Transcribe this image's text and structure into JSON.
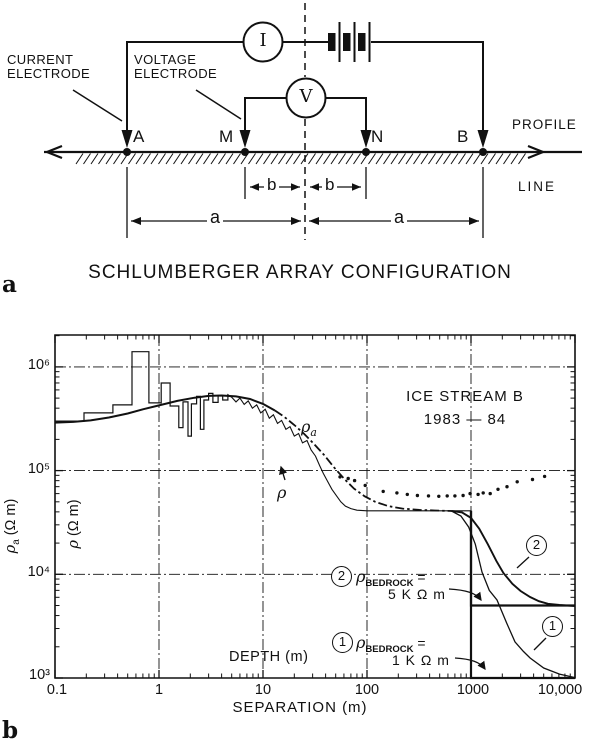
{
  "panel_a": {
    "label": "a",
    "title": "SCHLUMBERGER ARRAY CONFIGURATION",
    "current_electrode": "CURRENT\nELECTRODE",
    "voltage_electrode": "VOLTAGE\nELECTRODE",
    "ammeter": "I",
    "voltmeter": "V",
    "electrode_a": "A",
    "electrode_m": "M",
    "electrode_n": "N",
    "electrode_b": "B",
    "profile_word": "PROFILE",
    "line_word": "LINE",
    "dim_b": "b",
    "dim_a": "a"
  },
  "panel_b": {
    "label": "b",
    "legend1": "ICE STREAM B",
    "legend2": "1983 — 84",
    "rho": "ρ",
    "rho_a_sub": "a",
    "unit": " (Ω m)",
    "depth_label": "DEPTH (m)",
    "bedrock_sub": "BEDROCK",
    "eq": " =",
    "bedrock2_val": "5 K Ω m",
    "bedrock1_val": "1 K Ω m",
    "num1": "1",
    "num2": "2"
  },
  "chart_data": {
    "type": "line",
    "title": "ICE STREAM B 1983 — 84",
    "xlabel": "SEPARATION  (m)",
    "xlabel_secondary": "DEPTH (m)",
    "ylabel": "ρa (Ω m)",
    "ylabel_secondary": "ρ (Ω m)",
    "x_scale": "log",
    "y_scale": "log",
    "xlim": [
      0.1,
      10000
    ],
    "ylim": [
      1000,
      2000000
    ],
    "x_ticks": [
      0.1,
      1,
      10,
      100,
      1000,
      10000
    ],
    "x_tick_labels": [
      "0.1",
      "1",
      "10",
      "100",
      "1000",
      "10,000"
    ],
    "y_ticks": [
      1000,
      10000,
      100000,
      1000000
    ],
    "y_tick_labels": [
      "10³",
      "10⁴",
      "10⁵",
      "10⁶"
    ],
    "grid_x": [
      1,
      10,
      100,
      1000
    ],
    "grid_y": [
      10000,
      100000,
      1000000
    ],
    "annotations": [
      {
        "id": "2",
        "label": "ρ BEDROCK = 5 K Ω m",
        "value": 5000
      },
      {
        "id": "1",
        "label": "ρ BEDROCK = 1 K Ω m",
        "value": 1000
      }
    ],
    "series": [
      {
        "name": "measured-histogram",
        "style": "line",
        "width": 1.2,
        "points": [
          [
            0.1,
            300000
          ],
          [
            0.19,
            300000
          ],
          [
            0.19,
            360000
          ],
          [
            0.36,
            360000
          ],
          [
            0.36,
            430000
          ],
          [
            0.55,
            430000
          ],
          [
            0.55,
            1400000
          ],
          [
            0.8,
            1400000
          ],
          [
            0.8,
            450000
          ],
          [
            1.05,
            450000
          ],
          [
            1.05,
            700000
          ],
          [
            1.28,
            700000
          ],
          [
            1.28,
            420000
          ],
          [
            1.55,
            420000
          ],
          [
            1.55,
            260000
          ],
          [
            1.7,
            260000
          ],
          [
            1.7,
            460000
          ],
          [
            1.9,
            460000
          ],
          [
            1.9,
            215000
          ],
          [
            2.05,
            215000
          ],
          [
            2.05,
            440000
          ],
          [
            2.3,
            440000
          ],
          [
            2.3,
            520000
          ],
          [
            2.5,
            520000
          ],
          [
            2.5,
            250000
          ],
          [
            2.7,
            250000
          ],
          [
            2.7,
            480000
          ],
          [
            3.0,
            480000
          ],
          [
            3.0,
            555000
          ],
          [
            3.3,
            555000
          ],
          [
            3.3,
            455000
          ],
          [
            3.7,
            455000
          ],
          [
            3.7,
            530000
          ],
          [
            4.1,
            530000
          ],
          [
            4.1,
            480000
          ],
          [
            4.6,
            480000
          ],
          [
            4.6,
            540000
          ],
          [
            5.0,
            510000
          ]
        ]
      },
      {
        "name": "rho-interpreted-noisy",
        "style": "line",
        "width": 1.1,
        "points": [
          [
            5.0,
            510000
          ],
          [
            5.5,
            460000
          ],
          [
            6.0,
            500000
          ],
          [
            6.6,
            435000
          ],
          [
            7.2,
            470000
          ],
          [
            7.9,
            400000
          ],
          [
            8.7,
            430000
          ],
          [
            9.5,
            360000
          ],
          [
            10.5,
            390000
          ],
          [
            11.5,
            320000
          ],
          [
            12.6,
            345000
          ],
          [
            13.8,
            285000
          ],
          [
            15.1,
            305000
          ],
          [
            16.6,
            250000
          ],
          [
            18.2,
            265000
          ],
          [
            20,
            215000
          ],
          [
            22,
            228000
          ],
          [
            24,
            185000
          ],
          [
            26.5,
            195000
          ],
          [
            29,
            158000
          ],
          [
            32,
            138000
          ],
          [
            35,
            112000
          ],
          [
            38,
            94000
          ],
          [
            42,
            78000
          ],
          [
            46,
            66000
          ],
          [
            51,
            57000
          ],
          [
            56,
            50000
          ],
          [
            62,
            45500
          ],
          [
            70,
            43000
          ],
          [
            80,
            41500
          ],
          [
            100,
            41000
          ],
          [
            150,
            41000
          ],
          [
            250,
            41000
          ],
          [
            450,
            41000
          ],
          [
            700,
            41000
          ],
          [
            1000,
            41000
          ]
        ]
      },
      {
        "name": "rho-a-model-smooth",
        "style": "line",
        "width": 2,
        "points": [
          [
            0.1,
            290000
          ],
          [
            0.15,
            295000
          ],
          [
            0.22,
            305000
          ],
          [
            0.33,
            325000
          ],
          [
            0.5,
            355000
          ],
          [
            0.7,
            390000
          ],
          [
            1.0,
            425000
          ],
          [
            1.5,
            470000
          ],
          [
            2.2,
            505000
          ],
          [
            3.0,
            525000
          ],
          [
            4.0,
            530000
          ],
          [
            5.5,
            520000
          ],
          [
            7.5,
            490000
          ],
          [
            10,
            440000
          ],
          [
            13,
            380000
          ]
        ]
      },
      {
        "name": "rho-a-model-dashdot",
        "style": "line",
        "width": 1.8,
        "dash": "9 3 2.5 3",
        "points": [
          [
            13,
            380000
          ],
          [
            16,
            330000
          ],
          [
            20,
            275000
          ],
          [
            25,
            225000
          ],
          [
            31,
            180000
          ],
          [
            39,
            140000
          ],
          [
            48,
            108000
          ],
          [
            60,
            84000
          ],
          [
            75,
            67000
          ],
          [
            95,
            56500
          ],
          [
            120,
            50000
          ],
          [
            160,
            45500
          ],
          [
            220,
            43000
          ],
          [
            320,
            41800
          ],
          [
            450,
            41200
          ],
          [
            650,
            40800
          ]
        ]
      },
      {
        "name": "model-curve-2-bedrock-5k",
        "style": "line",
        "width": 1.9,
        "points": [
          [
            650,
            40900
          ],
          [
            820,
            39500
          ],
          [
            1000,
            35000
          ],
          [
            1200,
            27500
          ],
          [
            1450,
            19500
          ],
          [
            1750,
            13500
          ],
          [
            2050,
            10300
          ],
          [
            2500,
            8100
          ],
          [
            3000,
            6900
          ],
          [
            3700,
            6040
          ],
          [
            4500,
            5500
          ],
          [
            5500,
            5200
          ],
          [
            7100,
            5060
          ],
          [
            8500,
            4990
          ],
          [
            10000,
            4950
          ]
        ]
      },
      {
        "name": "model-curve-1-bedrock-1k",
        "style": "line",
        "width": 1.3,
        "points": [
          [
            650,
            40800
          ],
          [
            800,
            36500
          ],
          [
            950,
            28500
          ],
          [
            1100,
            19500
          ],
          [
            1275,
            10500
          ],
          [
            1500,
            7000
          ],
          [
            1780,
            5650
          ],
          [
            2200,
            3400
          ],
          [
            2650,
            2230
          ],
          [
            3200,
            1800
          ],
          [
            3700,
            1560
          ],
          [
            5000,
            1250
          ],
          [
            7100,
            1090
          ],
          [
            10000,
            1010
          ]
        ]
      },
      {
        "name": "rho-step-model-2",
        "style": "line",
        "width": 2.2,
        "points": [
          [
            1000,
            41000
          ],
          [
            1000,
            5000
          ],
          [
            10000,
            5000
          ]
        ]
      },
      {
        "name": "rho-step-model-1",
        "style": "line",
        "width": 2.2,
        "points": [
          [
            1000,
            41000
          ],
          [
            1000,
            1000
          ],
          [
            10000,
            1000
          ]
        ]
      },
      {
        "name": "measured-dots",
        "style": "dots",
        "width": 1.7,
        "points": [
          [
            55,
            87000
          ],
          [
            66,
            84000
          ],
          [
            76,
            80000
          ],
          [
            96,
            72000
          ],
          [
            143,
            63000
          ],
          [
            194,
            61000
          ],
          [
            244,
            59000
          ],
          [
            305,
            57500
          ],
          [
            390,
            57000
          ],
          [
            490,
            56500
          ],
          [
            590,
            57000
          ],
          [
            700,
            57000
          ],
          [
            840,
            57500
          ],
          [
            980,
            60000
          ],
          [
            1170,
            59000
          ],
          [
            1310,
            61000
          ],
          [
            1530,
            60000
          ],
          [
            1820,
            66000
          ],
          [
            2220,
            70000
          ],
          [
            2780,
            78000
          ],
          [
            3900,
            82000
          ],
          [
            5100,
            88000
          ]
        ]
      }
    ]
  }
}
